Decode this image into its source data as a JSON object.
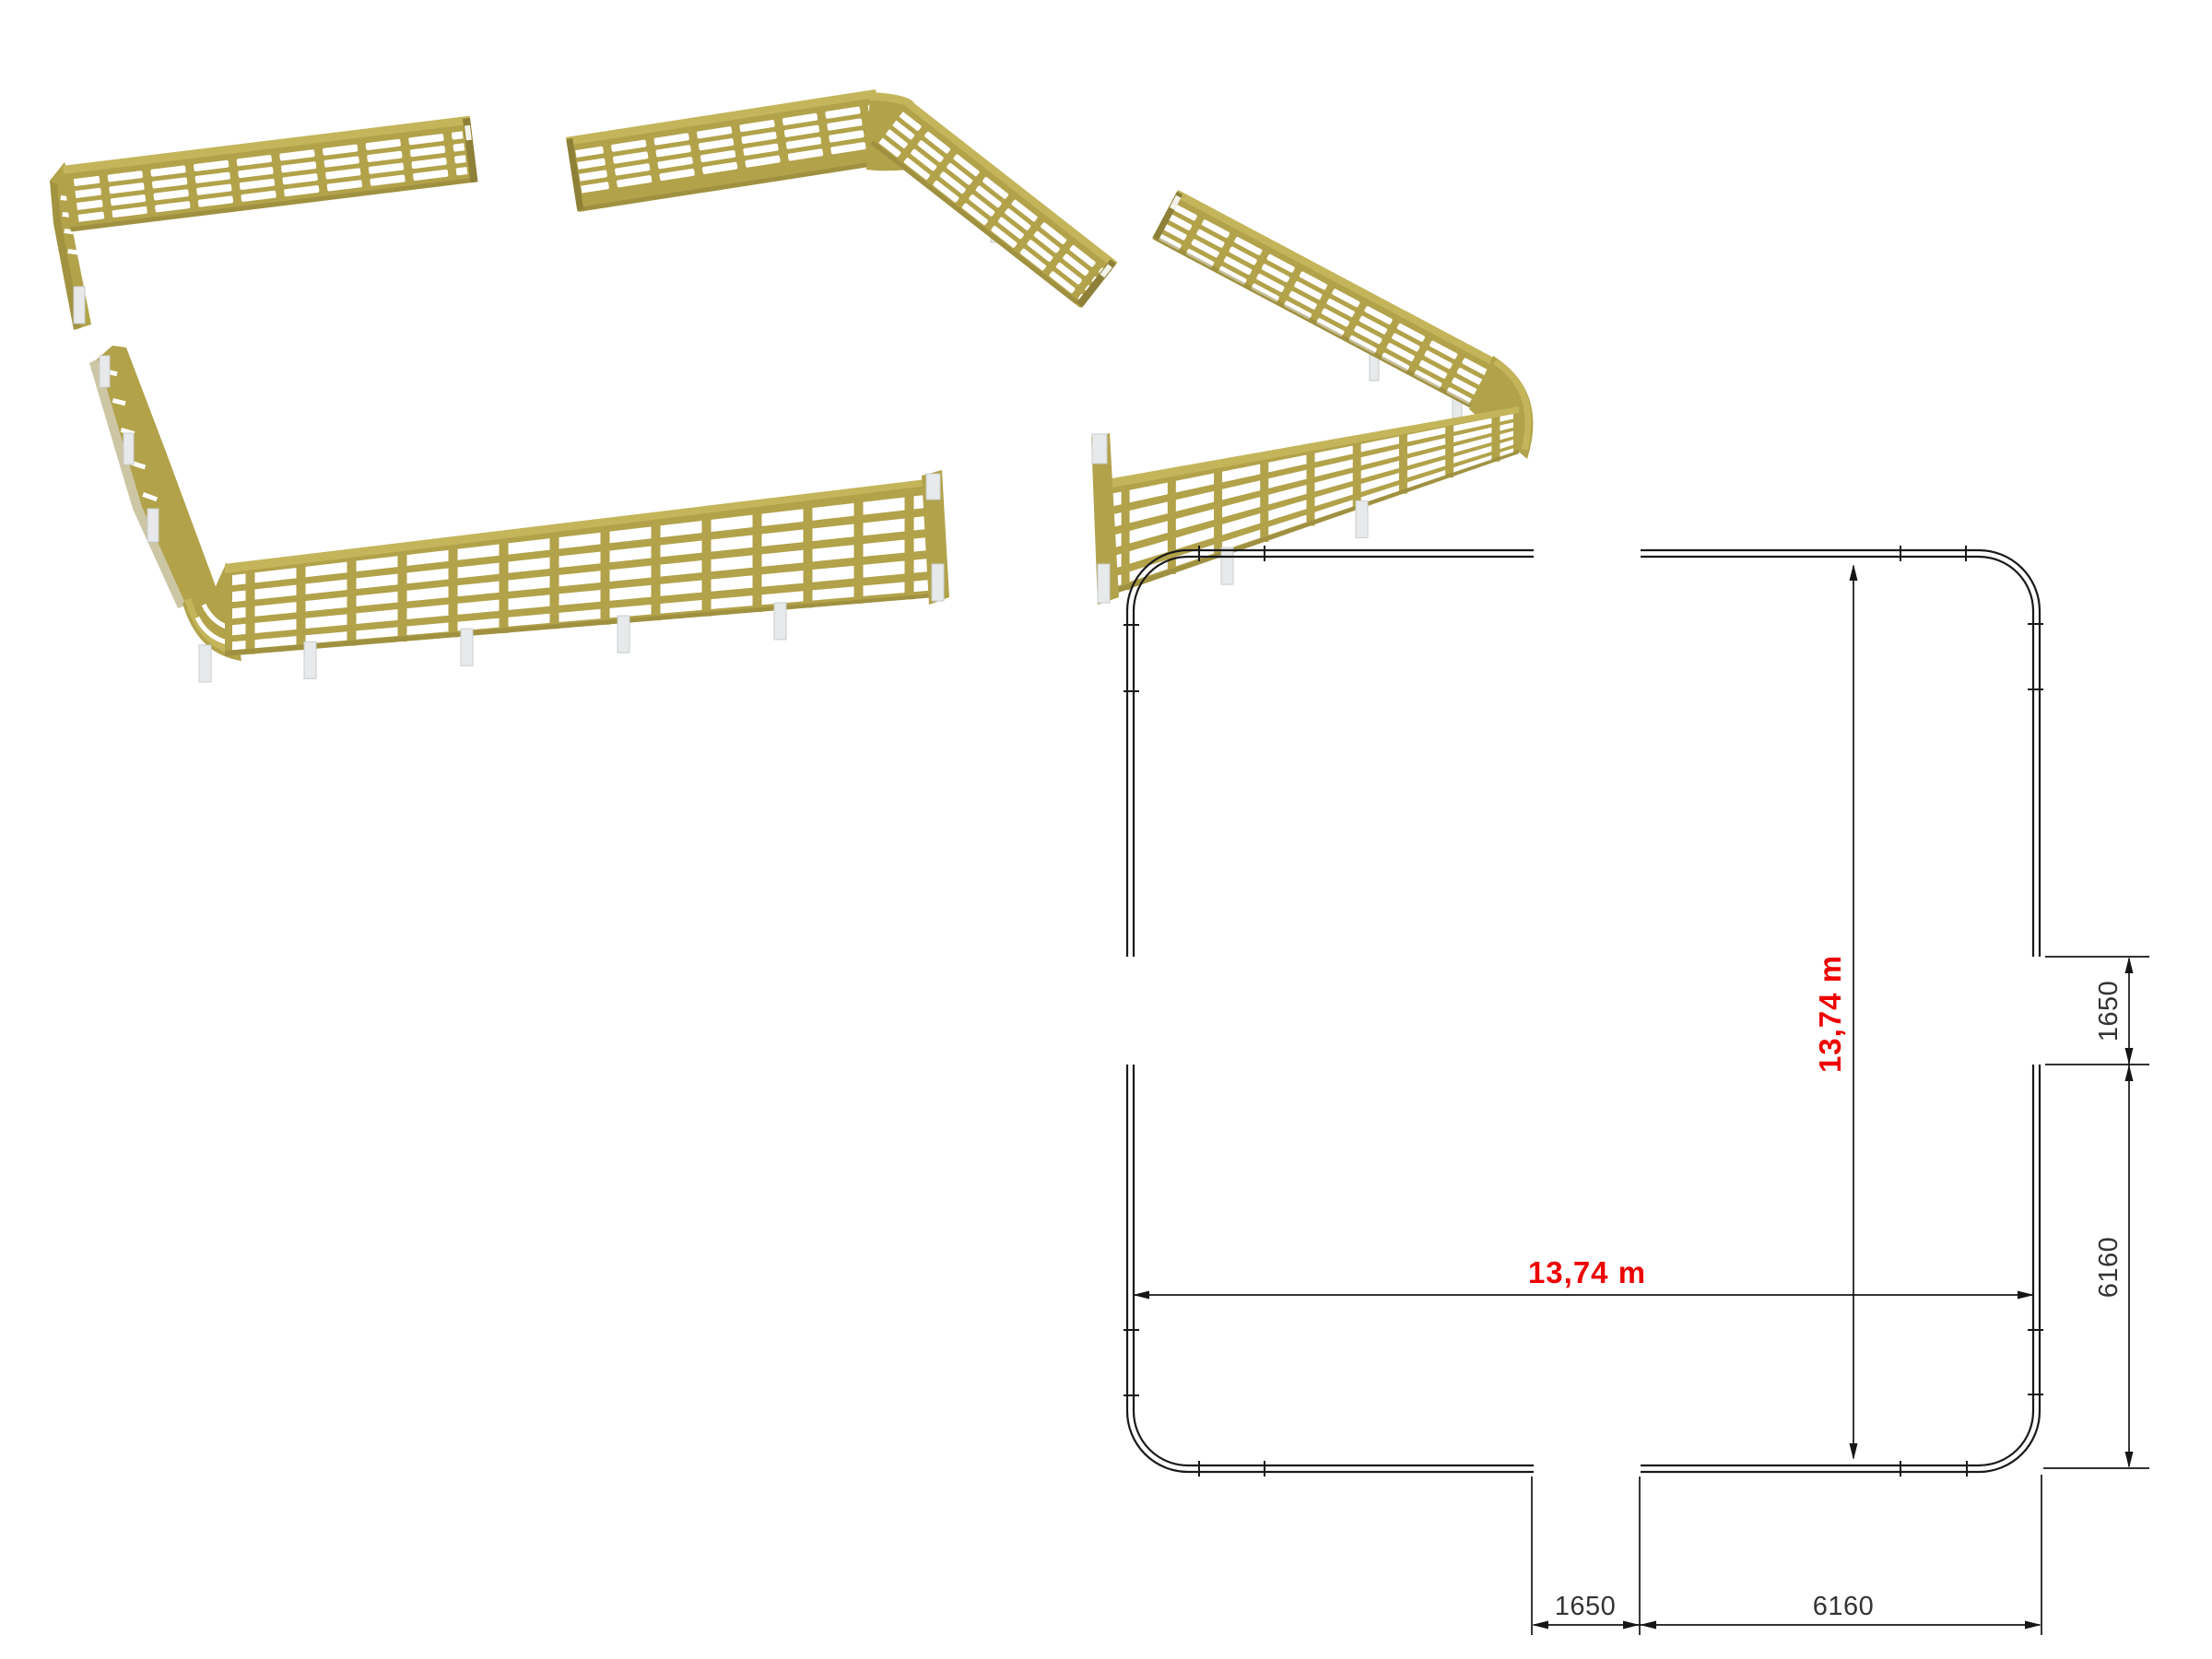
{
  "plan": {
    "width_label": "13,74 m",
    "height_label": "13,74 m",
    "dims": {
      "right_gap": "1650",
      "right_side": "6160",
      "bottom_gap": "1650",
      "bottom_side": "6160"
    }
  },
  "colors": {
    "fence": "#b2a24a",
    "fence_top": "#c4b55a",
    "fence_shadow": "#8e8038",
    "post_foot": "#e7e9ea",
    "dimension_red": "#ee0000",
    "drawing_line": "#1a1a1a",
    "dim_text": "#333333"
  }
}
